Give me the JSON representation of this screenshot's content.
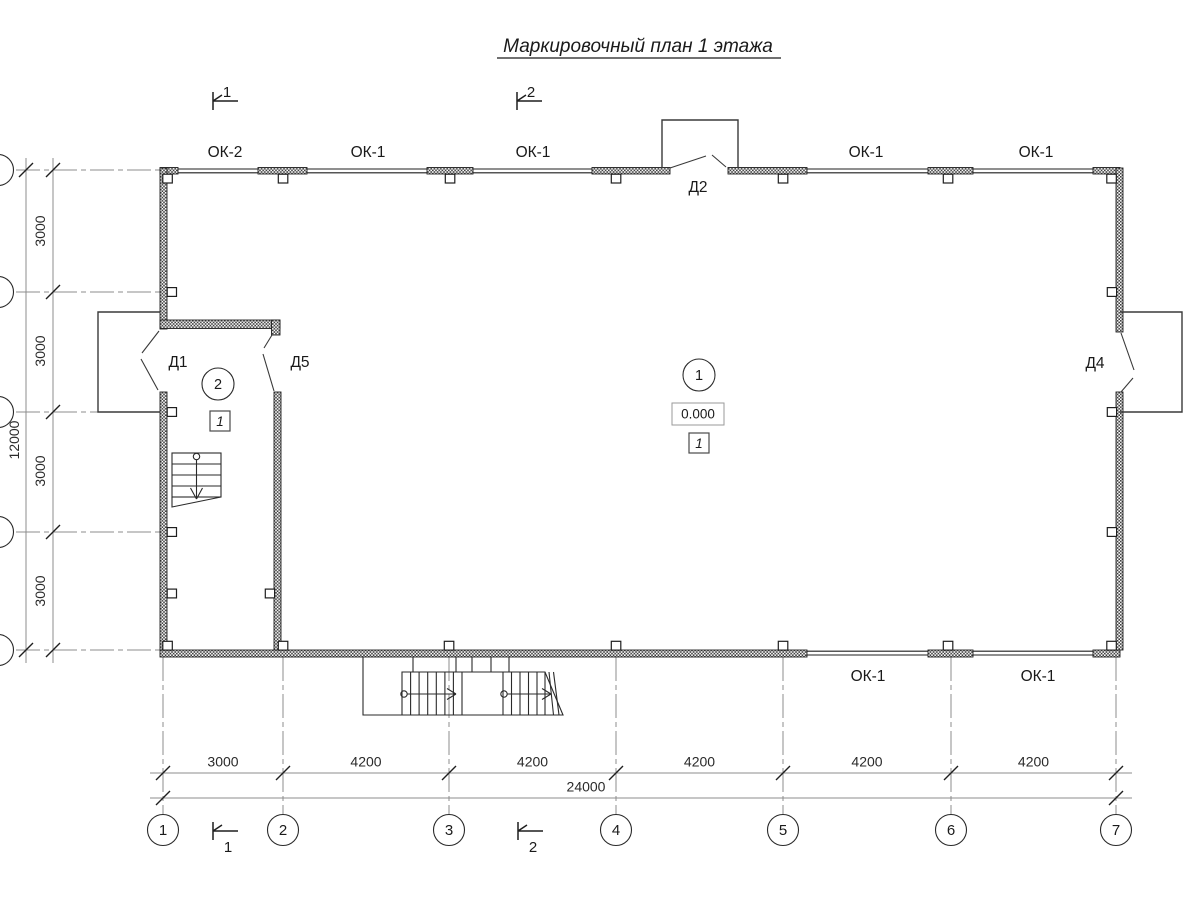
{
  "title": "Маркировочный план 1 этажа",
  "section_marks": {
    "top": [
      "1",
      "2"
    ],
    "bottom": [
      "1",
      "2"
    ]
  },
  "windows": {
    "top_labels": [
      "ОК-2",
      "ОК-1",
      "ОК-1",
      "ОК-1",
      "ОК-1"
    ],
    "bottom_labels": [
      "ОК-1",
      "ОК-1"
    ]
  },
  "doors": {
    "d1": "Д1",
    "d2": "Д2",
    "d4": "Д4",
    "d5": "Д5"
  },
  "rooms": {
    "main": {
      "number": "1",
      "elevation": "0.000",
      "finish_mark": "1"
    },
    "stair_room": {
      "number": "2",
      "finish_mark": "1"
    }
  },
  "dimensions": {
    "bottom_segments": [
      "3000",
      "4200",
      "4200",
      "4200",
      "4200",
      "4200"
    ],
    "bottom_total": "24000",
    "left_segments": [
      "3000",
      "3000",
      "3000",
      "3000"
    ],
    "left_total": "12000"
  },
  "axes": {
    "column_labels": [
      "1",
      "2",
      "3",
      "4",
      "5",
      "6",
      "7"
    ]
  }
}
